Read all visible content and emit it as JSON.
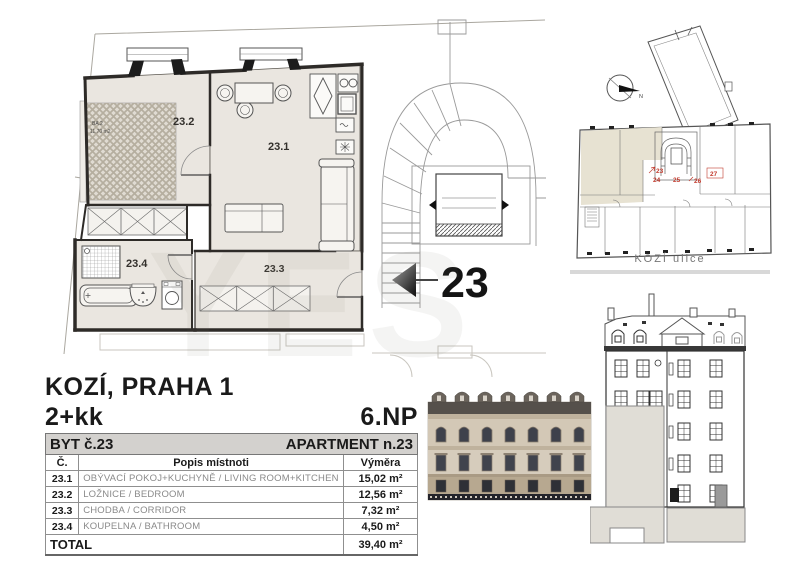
{
  "document": {
    "title": "KOZÍ, PRAHA 1",
    "disposition": "2+kk",
    "floor": "6.NP"
  },
  "unit_table": {
    "title_cz": "BYT č.23",
    "title_en": "APARTMENT n.23",
    "col_num": "Č.",
    "col_desc": "Popis místnoti",
    "col_area": "Výměra",
    "rows": [
      {
        "num": "23.1",
        "name": "OBÝVACÍ POKOJ+KUCHYNĚ / LIVING ROOM+KITCHEN",
        "area": "15,02 m²"
      },
      {
        "num": "23.2",
        "name": "LOŽNICE / BEDROOM",
        "area": "12,56 m²"
      },
      {
        "num": "23.3",
        "name": "CHODBA / CORRIDOR",
        "area": "7,32 m²"
      },
      {
        "num": "23.4",
        "name": "KOUPELNA / BATHROOM",
        "area": "4,50 m²"
      }
    ],
    "total_label": "TOTAL",
    "total_area": "39,40 m²"
  },
  "floorplan": {
    "living": "23.1",
    "bedroom": "23.2",
    "corridor": "23.3",
    "bathroom": "23.4",
    "unit_marker": "23",
    "bed_tag_line1": "BA.2",
    "bed_tag_line2": "11,70 m2"
  },
  "siteplan": {
    "street": "KOZÍ ulice",
    "units": [
      "23",
      "24",
      "25",
      "26",
      "27"
    ]
  },
  "watermark": "YES",
  "colors": {
    "room_fill": "#eae6e0",
    "highlight_fill": "#e7e2d2",
    "accent_red": "#c23b2e",
    "table_header_bg": "#d3d1ce",
    "wall": "#2e2b28"
  }
}
